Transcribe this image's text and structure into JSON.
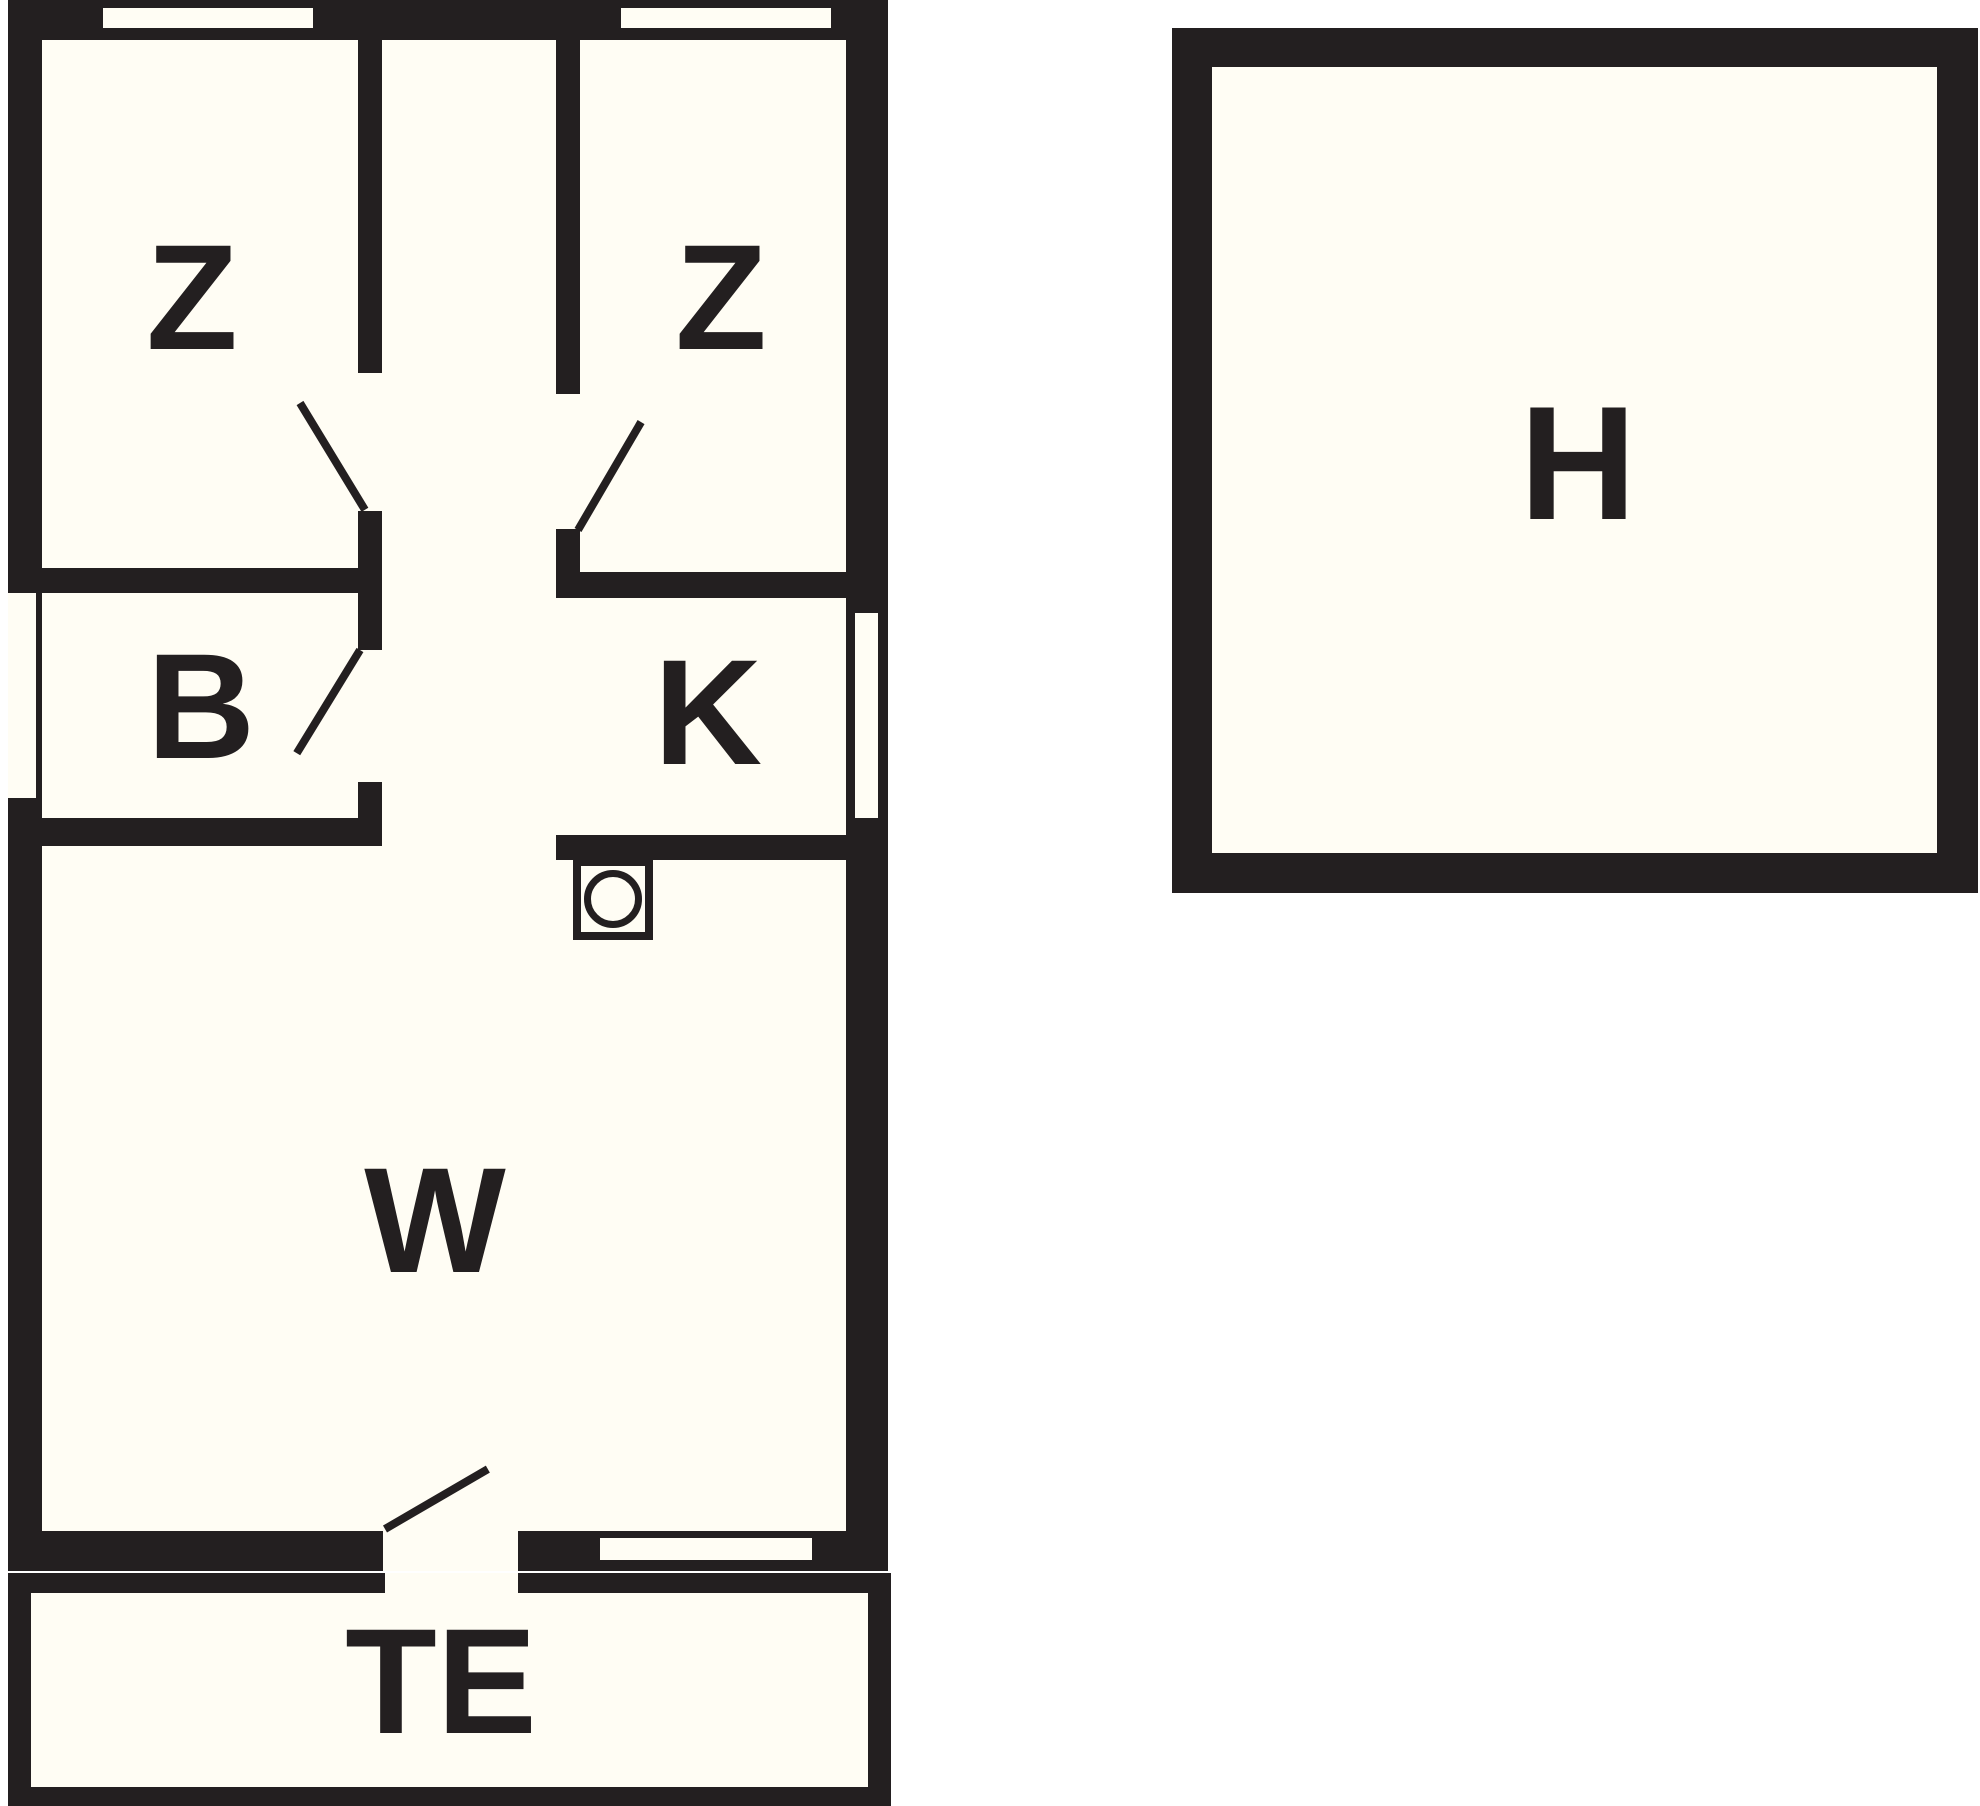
{
  "colors": {
    "wall": "#231f20",
    "floor": "#fffdf4",
    "background": "#ffffff"
  },
  "main_building": {
    "rooms": {
      "bedroom_left": {
        "label": "Z"
      },
      "bedroom_right": {
        "label": "Z"
      },
      "bathroom": {
        "label": "B"
      },
      "kitchen": {
        "label": "K"
      },
      "living_room": {
        "label": "W"
      },
      "terrace": {
        "label": "TE"
      }
    },
    "fixtures": {
      "washing_machine": {
        "icon": "washing-machine-icon"
      }
    }
  },
  "outbuilding": {
    "room": {
      "label": "H"
    }
  }
}
